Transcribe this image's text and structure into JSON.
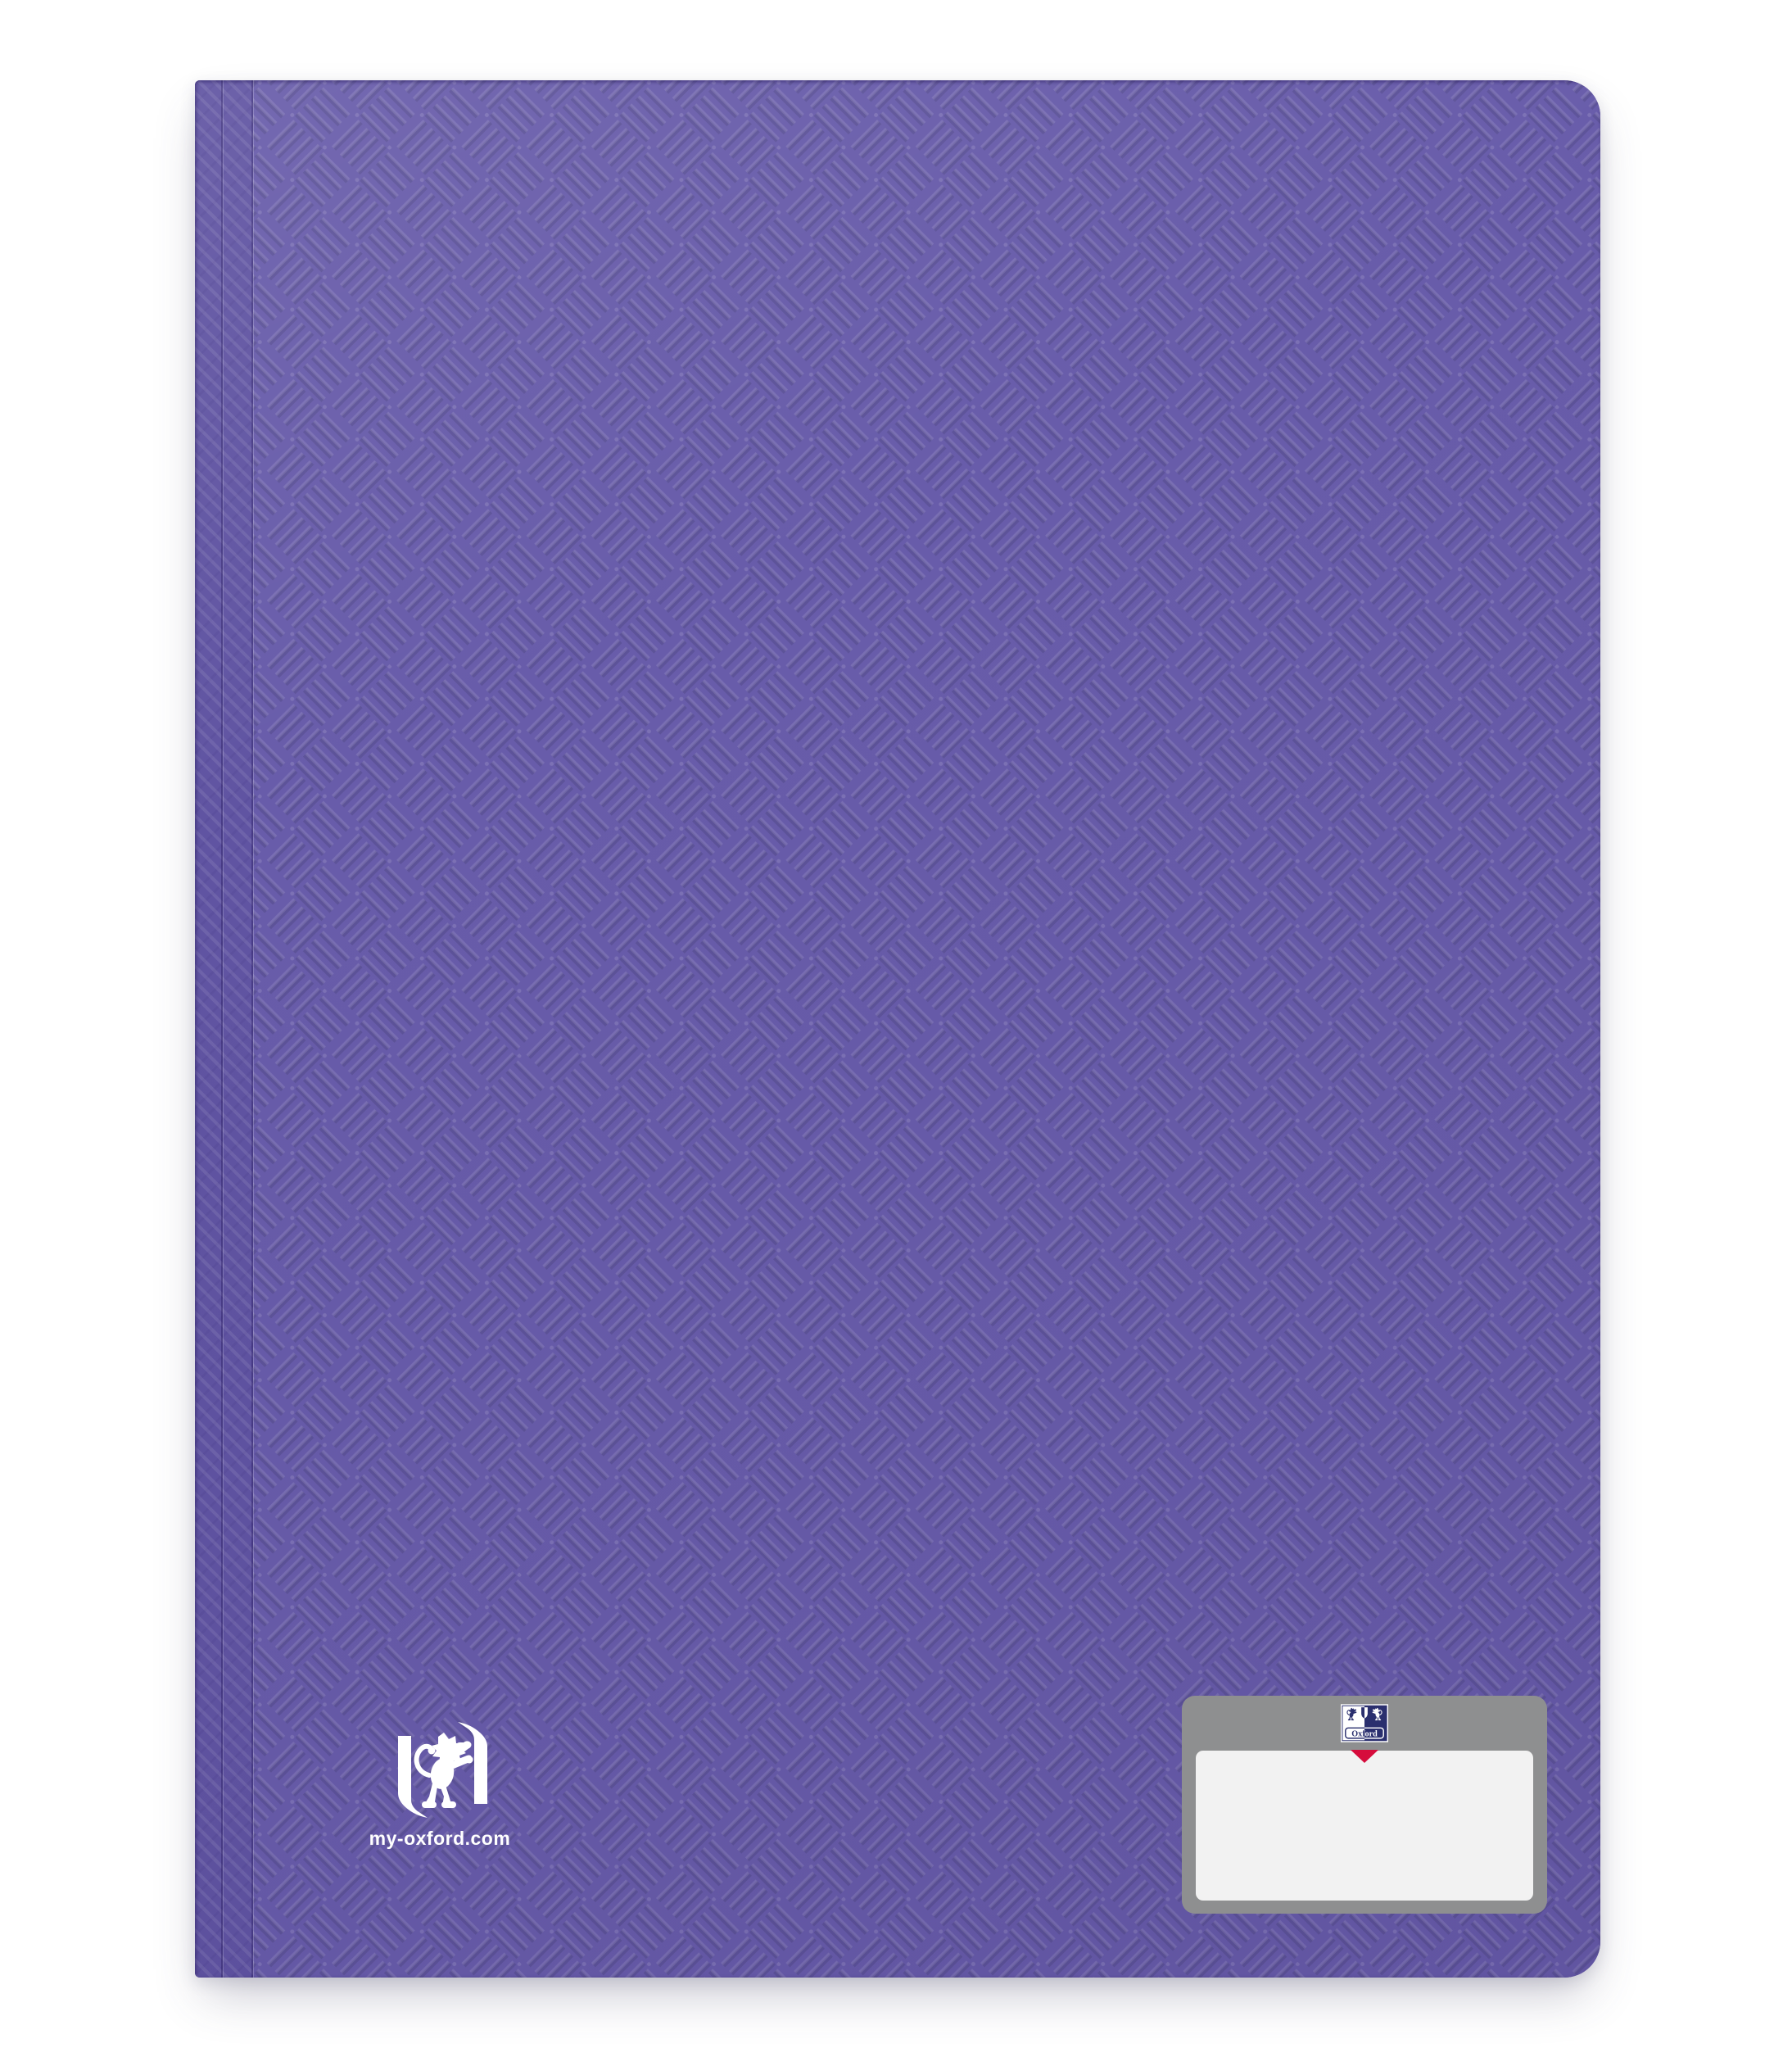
{
  "product": {
    "type": "display-book-cover",
    "color_name": "purple"
  },
  "colors": {
    "page_bg": "#FFFFFF",
    "cover": "#685CAA",
    "cover_light_lines": "#7A70BA",
    "cover_dark_lines": "#5A4E98",
    "spine": "#6054A2",
    "plate_gray": "#8E8F90",
    "plate_white": "#F2F2F2",
    "accent_red": "#D60C3C",
    "oxford_navy": "#2A2F6E",
    "logo_white": "#FFFFFF",
    "signature_line": "#858585"
  },
  "branding": {
    "lion_logo": "oxford-lion-in-brackets",
    "website": "my-oxford.com"
  },
  "label_plate": {
    "brand": "Oxford",
    "crest_icon": "oxford-crest",
    "marker_icon": "red-arrow-down",
    "name_area_value": "",
    "has_signature_line": true
  }
}
